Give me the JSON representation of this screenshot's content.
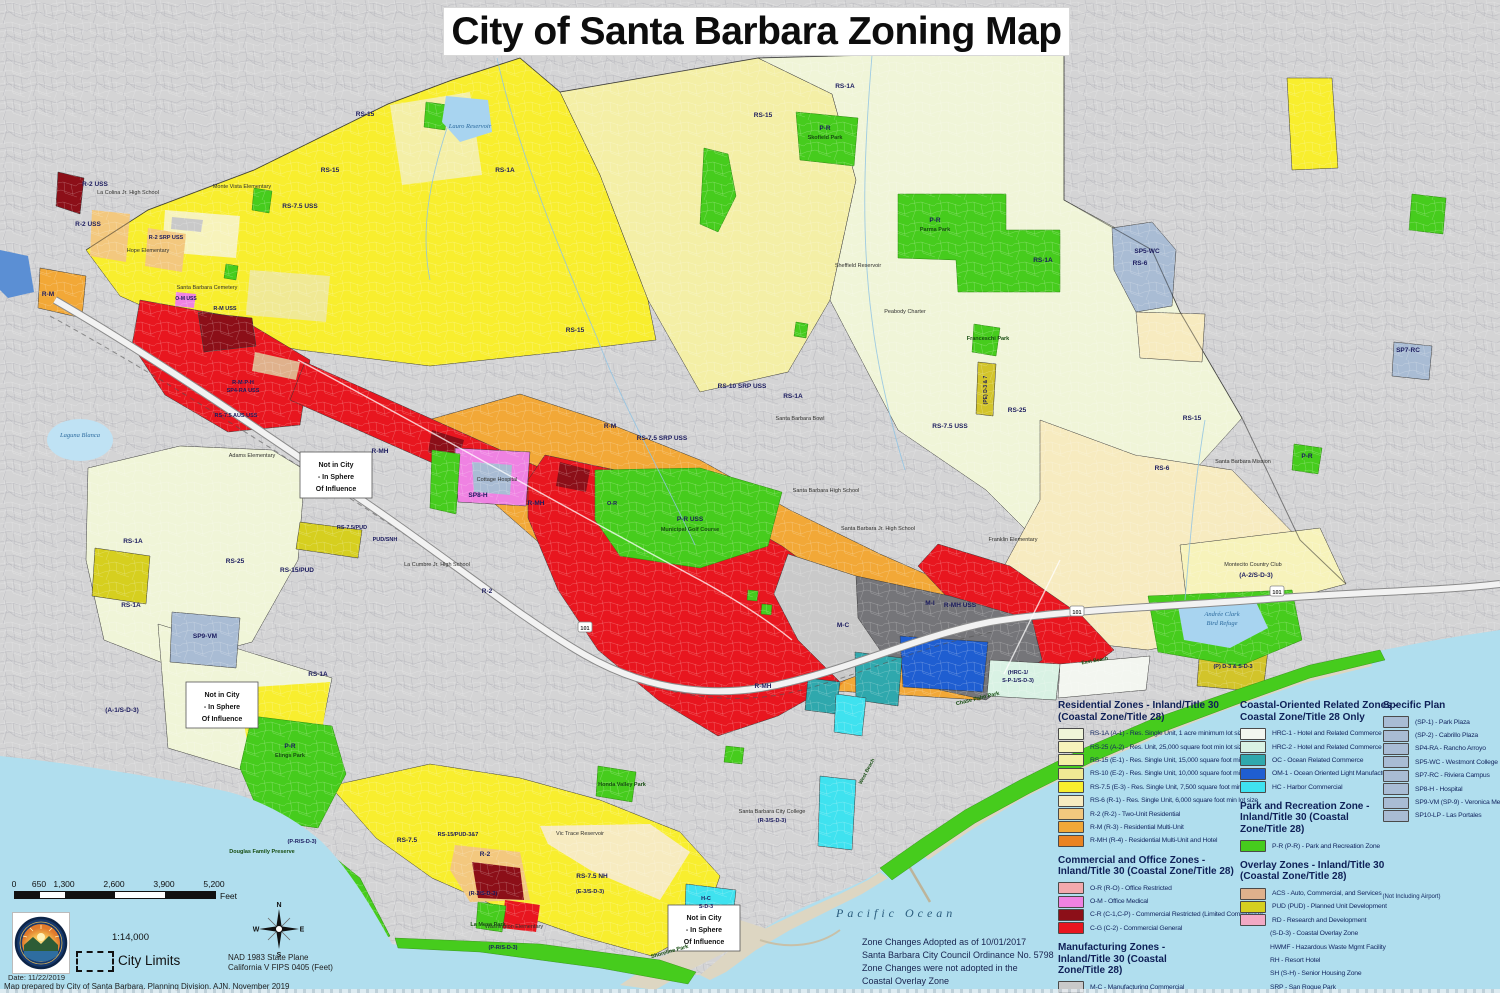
{
  "title": "City of Santa Barbara Zoning Map",
  "ocean_label": "Pacific Ocean",
  "notes": {
    "zone_changes": [
      "Zone Changes Adopted as of 10/01/2017",
      "Santa Barbara City Council Ordinance No. 5798",
      "Zone Changes were not adopted in the",
      "Coastal Overlay Zone"
    ]
  },
  "footer": {
    "scalebar": {
      "ticks": [
        "0",
        "650",
        "1,300",
        "2,600",
        "3,900",
        "5,200"
      ],
      "values": [
        0,
        650,
        1300,
        2600,
        3900,
        5200
      ],
      "unit": "Feet"
    },
    "ratio": "1:14,000",
    "city_limits": "City Limits",
    "compass": {
      "n": "N",
      "e": "E",
      "s": "S",
      "w": "W"
    },
    "datum": [
      "NAD 1983 State Plane",
      "California V FIPS 0405 (Feet)"
    ],
    "date": "Date: 11/22/2019",
    "prepared": "Map prepared by City of Santa Barbara, Planning Division, AJN, November 2019"
  },
  "legend": {
    "sections": [
      {
        "col": 0,
        "w": 178,
        "title": "Residential Zones - Inland/Title 30 (Coastal Zone/Title 28)",
        "items": [
          {
            "swatch": "#f0f5d8",
            "label": "RS-1A (A-1) - Res. Single Unit, 1 acre minimum lot size"
          },
          {
            "swatch": "#f7f3bb",
            "label": "RS-25 (A-2) - Res. Unit, 25,000 square foot min lot size"
          },
          {
            "swatch": "#f4efa6",
            "label": "RS-15 (E-1) - Res. Single Unit, 15,000 square foot min lot size"
          },
          {
            "swatch": "#f0e994",
            "label": "RS-10 (E-2) - Res. Single Unit, 10,000 square foot min lot size"
          },
          {
            "swatch": "#f8ee2e",
            "label": "RS-7.5 (E-3) - Res. Single Unit, 7,500 square foot min lot size"
          },
          {
            "swatch": "#f7ebc0",
            "label": "RS-6 (R-1) - Res. Single Unit, 6,000 square foot min lot size"
          },
          {
            "swatch": "#f3c87e",
            "label": "R-2 (R-2) - Two-Unit Residential"
          },
          {
            "swatch": "#f2a837",
            "label": "R-M (R-3) - Residential Multi-Unit"
          },
          {
            "swatch": "#ea8322",
            "label": "R-MH (R-4) - Residential Multi-Unit and Hotel"
          }
        ]
      },
      {
        "col": 0,
        "w": 178,
        "title": "Commercial and Office Zones - Inland/Title 30 (Coastal Zone/Title 28)",
        "items": [
          {
            "swatch": "#f2a9ad",
            "label": "O-R (R-O) - Office Restricted"
          },
          {
            "swatch": "#ef82e2",
            "label": "O-M - Office Medical"
          },
          {
            "swatch": "#8c0f18",
            "label": "C-R (C-1,C-P) - Commercial Restricted (Limited Commercial)"
          },
          {
            "swatch": "#e8161f",
            "label": "C-G (C-2) - Commercial General"
          }
        ]
      },
      {
        "col": 0,
        "w": 128,
        "title": "Manufacturing Zones - Inland/Title 30 (Coastal Zone/Title 28)",
        "items": [
          {
            "swatch": "#c9c9c9",
            "label": "M-C - Manufacturing Commercial"
          },
          {
            "swatch": "#757579",
            "label": "M-I (M-1) - Light Manufacturing"
          }
        ]
      },
      {
        "col": 1,
        "w": 158,
        "title": "Coastal-Oriented Related Zones - Coastal Zone/Title 28 Only",
        "items": [
          {
            "swatch": "#f3f6f0",
            "label": "HRC-1 - Hotel and Related Commerce I"
          },
          {
            "swatch": "#d9f2e4",
            "label": "HRC-2 - Hotel and Related Commerce II"
          },
          {
            "swatch": "#2fa8ad",
            "label": "OC - Ocean Related Commerce"
          },
          {
            "swatch": "#1f5ed1",
            "label": "OM-1 - Ocean Oriented Light Manufacturing"
          },
          {
            "swatch": "#3fe2ef",
            "label": "HC - Harbor Commercial"
          }
        ]
      },
      {
        "col": 1,
        "w": 135,
        "title": "Park and Recreation Zone - Inland/Title 30 (Coastal Zone/Title 28)",
        "items": [
          {
            "swatch": "#46cc1d",
            "label": "P-R (P-R) - Park and Recreation Zone"
          }
        ]
      },
      {
        "col": 1,
        "w": 152,
        "title": "Overlay Zones - Inland/Title 30 (Coastal Zone/Title 28)",
        "items": [
          {
            "swatch": "#dfb18c",
            "label": "ACS - Auto, Commercial, and Services",
            "note": "(Not Including Airport)"
          },
          {
            "swatch": "#d6cf1f",
            "label": "PUD (PUD) - Planned Unit Development"
          },
          {
            "swatch": "#f2a9c4",
            "label": "RD - Research and Development"
          },
          {
            "label": "(S-D-3) - Coastal Overlay Zone"
          },
          {
            "label": "HWMF - Hazardous Waste Mgmt Facility"
          },
          {
            "label": "RH - Resort Hotel"
          },
          {
            "label": "SH (S-H) - Senior Housing Zone"
          },
          {
            "label": "SRP - San Roque Park"
          },
          {
            "label": "USS - Upper State Street Area"
          }
        ]
      },
      {
        "col": 2,
        "w": 120,
        "title": "Specific Plan",
        "items": [
          {
            "swatch": "#a9bcd4",
            "label": "(SP-1) - Park Plaza"
          },
          {
            "swatch": "#a9bcd4",
            "label": "(SP-2) - Cabrillo Plaza"
          },
          {
            "swatch": "#a9bcd4",
            "label": "SP4-RA - Rancho Arroyo"
          },
          {
            "swatch": "#a9bcd4",
            "label": "SP5-WC - Westmont College"
          },
          {
            "swatch": "#a9bcd4",
            "label": "SP7-RC - Riviera Campus"
          },
          {
            "swatch": "#a9bcd4",
            "label": "SP8-H - Hospital"
          },
          {
            "swatch": "#a9bcd4",
            "label": "SP9-VM (SP-9) - Veronica Meadows"
          },
          {
            "swatch": "#a9bcd4",
            "label": "SP10-LP - Las Portales"
          }
        ]
      }
    ]
  },
  "map": {
    "not_in_city": [
      "Not in City",
      "- In Sphere",
      "Of Influence"
    ],
    "boxes": [
      {
        "x": 300,
        "y": 452
      },
      {
        "x": 186,
        "y": 682
      },
      {
        "x": 668,
        "y": 905
      }
    ],
    "shield_label": "101",
    "shields": [
      {
        "x": 585,
        "y": 628
      },
      {
        "x": 1077,
        "y": 612
      },
      {
        "x": 1277,
        "y": 592
      }
    ],
    "labels": [
      {
        "t": "RS-1A",
        "x": 845,
        "y": 88
      },
      {
        "t": "RS-1A",
        "x": 505,
        "y": 172
      },
      {
        "t": "RS-1A",
        "x": 1043,
        "y": 262
      },
      {
        "t": "RS-1A",
        "x": 793,
        "y": 398
      },
      {
        "t": "RS-1A",
        "x": 133,
        "y": 543
      },
      {
        "t": "RS-1A",
        "x": 131,
        "y": 607
      },
      {
        "t": "RS-1A",
        "x": 318,
        "y": 676
      },
      {
        "t": "RS-15",
        "x": 365,
        "y": 116
      },
      {
        "t": "RS-15",
        "x": 330,
        "y": 172
      },
      {
        "t": "RS-15",
        "x": 763,
        "y": 117
      },
      {
        "t": "RS-15",
        "x": 575,
        "y": 332
      },
      {
        "t": "RS-15",
        "x": 1192,
        "y": 420
      },
      {
        "t": "RS-25",
        "x": 1017,
        "y": 412
      },
      {
        "t": "RS-25",
        "x": 235,
        "y": 563
      },
      {
        "t": "RS-7.5 USS",
        "x": 300,
        "y": 208
      },
      {
        "t": "RS-7.5 USS",
        "x": 950,
        "y": 428
      },
      {
        "t": "RS-7.5",
        "x": 407,
        "y": 842
      },
      {
        "t": "RS-7.5 NH",
        "x": 592,
        "y": 878
      },
      {
        "t": "RS-15/PUD-3&7",
        "x": 458,
        "y": 836,
        "s": 5.5
      },
      {
        "t": "RS-10 SRP USS",
        "x": 742,
        "y": 388
      },
      {
        "t": "RS-7.5 SRP USS",
        "x": 662,
        "y": 440
      },
      {
        "t": "R-2 SRP USS",
        "x": 166,
        "y": 239,
        "s": 5.5
      },
      {
        "t": "RS-7.5 AUS USS",
        "x": 236,
        "y": 417,
        "s": 5.5
      },
      {
        "t": "RS-6",
        "x": 1140,
        "y": 265
      },
      {
        "t": "RS-6",
        "x": 1162,
        "y": 470
      },
      {
        "t": "R-2 USS",
        "x": 95,
        "y": 186
      },
      {
        "t": "R-2 USS",
        "x": 88,
        "y": 226
      },
      {
        "t": "R-2",
        "x": 485,
        "y": 856
      },
      {
        "t": "R-2",
        "x": 487,
        "y": 593
      },
      {
        "t": "R-M",
        "x": 48,
        "y": 296
      },
      {
        "t": "R-M",
        "x": 610,
        "y": 428
      },
      {
        "t": "R-M USS",
        "x": 225,
        "y": 310,
        "s": 5.5
      },
      {
        "t": "R-MH",
        "x": 380,
        "y": 453
      },
      {
        "t": "R-MH",
        "x": 536,
        "y": 505
      },
      {
        "t": "R-MH",
        "x": 763,
        "y": 688
      },
      {
        "t": "R-MH USS",
        "x": 960,
        "y": 607
      },
      {
        "t": "M-C",
        "x": 843,
        "y": 627
      },
      {
        "t": "M-I",
        "x": 930,
        "y": 605
      },
      {
        "t": "O-M USS",
        "x": 186,
        "y": 300,
        "s": 5
      },
      {
        "t": "O-R",
        "x": 612,
        "y": 505,
        "s": 5.5
      },
      {
        "t": "SP5-WC",
        "x": 1147,
        "y": 253
      },
      {
        "t": "SP9-VM",
        "x": 205,
        "y": 638
      },
      {
        "t": "SP7-RC",
        "x": 1408,
        "y": 352
      },
      {
        "t": "SP8-H",
        "x": 478,
        "y": 497
      },
      {
        "t": "R-M-P-H",
        "x": 243,
        "y": 384,
        "s": 5.5
      },
      {
        "t": "SP4-RA USS",
        "x": 243,
        "y": 392,
        "s": 5.5
      },
      {
        "t": "RS-15/PUD",
        "x": 297,
        "y": 572
      },
      {
        "t": "RS-7.5/PUD",
        "x": 352,
        "y": 529,
        "s": 5.5
      },
      {
        "t": "PUD/SNH",
        "x": 385,
        "y": 541,
        "s": 5.5
      },
      {
        "t": "(A-1/S-D-3)",
        "x": 122,
        "y": 712
      },
      {
        "t": "(A-2/S-D-3)",
        "x": 1256,
        "y": 577
      },
      {
        "t": "(HRC-1/",
        "x": 1018,
        "y": 674,
        "s": 5.5
      },
      {
        "t": "S-P-1/S-D-3)",
        "x": 1018,
        "y": 682,
        "s": 5.5
      },
      {
        "t": "(P-R/S-D-3)",
        "x": 302,
        "y": 843,
        "s": 5.5
      },
      {
        "t": "(R-2/S-D-3)",
        "x": 483,
        "y": 895,
        "s": 5.5
      },
      {
        "t": "(E-3/S-D-3)",
        "x": 590,
        "y": 893,
        "s": 5.5
      },
      {
        "t": "(P-R/S-D-3)",
        "x": 503,
        "y": 949,
        "s": 5.5
      },
      {
        "t": "H-C",
        "x": 706,
        "y": 900,
        "s": 5.5
      },
      {
        "t": "S-D-3",
        "x": 706,
        "y": 908,
        "s": 5.5
      },
      {
        "t": "(R-3/S-D-3)",
        "x": 772,
        "y": 822,
        "s": 5.5
      },
      {
        "t": "(PE) D-3 & 7",
        "x": 987,
        "y": 390,
        "s": 5,
        "r": -90
      },
      {
        "t": "(P) D-3 & S-D-3",
        "x": 1233,
        "y": 668,
        "s": 5.5
      },
      {
        "t": "La Colina Jr. High School",
        "x": 128,
        "y": 194,
        "c": "k"
      },
      {
        "t": "Monte Vista Elementary",
        "x": 242,
        "y": 188,
        "c": "k"
      },
      {
        "t": "Hope Elementary",
        "x": 148,
        "y": 252,
        "c": "k"
      },
      {
        "t": "Santa Barbara Cemetery",
        "x": 207,
        "y": 289,
        "c": "k"
      },
      {
        "t": "Peabody Charter",
        "x": 905,
        "y": 313,
        "c": "k"
      },
      {
        "t": "La Cumbre Jr. High School",
        "x": 437,
        "y": 566,
        "c": "k"
      },
      {
        "t": "Santa Barbara High School",
        "x": 826,
        "y": 492,
        "c": "k"
      },
      {
        "t": "Santa Barbara Jr. High School",
        "x": 878,
        "y": 530,
        "c": "k"
      },
      {
        "t": "Franklin Elementary",
        "x": 1013,
        "y": 541,
        "c": "k"
      },
      {
        "t": "Washington Elementary",
        "x": 514,
        "y": 928,
        "c": "k"
      },
      {
        "t": "Santa Barbara City College",
        "x": 772,
        "y": 813,
        "c": "k"
      },
      {
        "t": "Cottage Hospital",
        "x": 497,
        "y": 481,
        "c": "k"
      },
      {
        "t": "Santa Barbara Mission",
        "x": 1243,
        "y": 463,
        "c": "k"
      },
      {
        "t": "Santa Barbara Bowl",
        "x": 800,
        "y": 420,
        "c": "k"
      },
      {
        "t": "Montecito Country Club",
        "x": 1253,
        "y": 566,
        "c": "k"
      },
      {
        "t": "Adams Elementary",
        "x": 252,
        "y": 457,
        "c": "k"
      },
      {
        "t": "Vic Trace Reservoir",
        "x": 580,
        "y": 835,
        "c": "k"
      },
      {
        "t": "Sheffield Reservoir",
        "x": 858,
        "y": 267,
        "c": "k"
      },
      {
        "t": "P-R",
        "x": 935,
        "y": 222
      },
      {
        "t": "Parma Park",
        "x": 935,
        "y": 231,
        "c": "p"
      },
      {
        "t": "P-R",
        "x": 825,
        "y": 130
      },
      {
        "t": "Skofield Park",
        "x": 825,
        "y": 139,
        "c": "p"
      },
      {
        "t": "Franceschi Park",
        "x": 988,
        "y": 340,
        "c": "p"
      },
      {
        "t": "P-R",
        "x": 290,
        "y": 748
      },
      {
        "t": "Elings Park",
        "x": 290,
        "y": 757,
        "c": "p"
      },
      {
        "t": "Douglas Family Preserve",
        "x": 262,
        "y": 853,
        "c": "p"
      },
      {
        "t": "La Mesa Park",
        "x": 488,
        "y": 926,
        "c": "p"
      },
      {
        "t": "Honda Valley Park",
        "x": 622,
        "y": 786,
        "c": "p"
      },
      {
        "t": "P-R USS",
        "x": 690,
        "y": 521
      },
      {
        "t": "Municipal Golf Course",
        "x": 690,
        "y": 531,
        "c": "p"
      },
      {
        "t": "Chase Palm Park",
        "x": 978,
        "y": 700,
        "c": "p",
        "r": -14
      },
      {
        "t": "Shoreline Park",
        "x": 670,
        "y": 953,
        "c": "p",
        "r": -16
      },
      {
        "t": "P-R",
        "x": 1307,
        "y": 458
      },
      {
        "t": "Lauro Reservoir",
        "x": 470,
        "y": 128,
        "c": "w"
      },
      {
        "t": "Laguna Blanca",
        "x": 80,
        "y": 437,
        "c": "w"
      },
      {
        "t": "Andrée Clark",
        "x": 1222,
        "y": 616,
        "c": "w"
      },
      {
        "t": "Bird Refuge",
        "x": 1222,
        "y": 625,
        "c": "w"
      },
      {
        "t": "West Beach",
        "x": 868,
        "y": 772,
        "c": "p",
        "r": -62,
        "s": 5
      },
      {
        "t": "East Beach",
        "x": 1095,
        "y": 662,
        "c": "p",
        "r": -10,
        "s": 5
      }
    ]
  }
}
